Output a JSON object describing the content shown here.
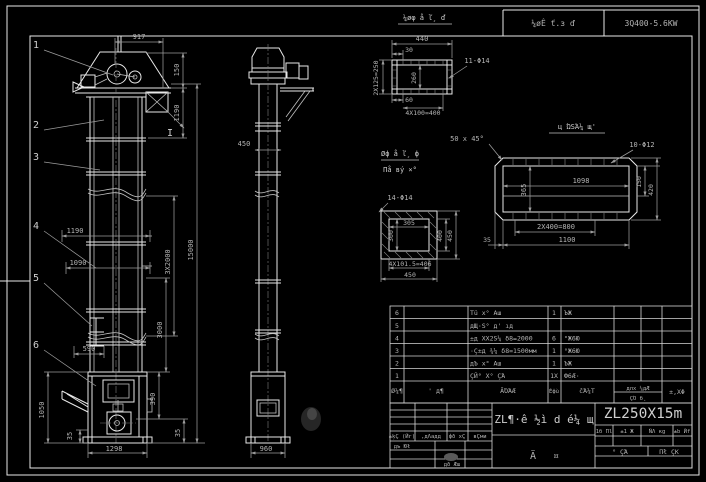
{
  "colors": {
    "background": "#000000",
    "geometry": "#e8e8e8",
    "dimension": "#9c9c9c",
    "text": "#b4b4b4"
  },
  "header": {
    "note": "¼øÊ ť.з ď",
    "spec": "3Q400-5.6KW"
  },
  "front": {
    "balloons": [
      "1",
      "2",
      "3",
      "4",
      "5",
      "6"
    ],
    "section_mark": "I",
    "dims": {
      "top_width": "917",
      "head_h": "150",
      "upper_h": "1190",
      "platform_w1": "1190",
      "platform_w2": "1090",
      "overall_h": "15000",
      "mid_h": "3Χ2000",
      "lower_h": "3000",
      "bucket_pitch": "590",
      "boot_h": "1050",
      "boot_gap": "35",
      "boot_w": "1298",
      "right_mid": "390",
      "right_low": "35"
    }
  },
  "side": {
    "dims": {
      "head_w": "450",
      "boot_w": "960"
    }
  },
  "flange": {
    "title": "¼øφ å ľ¸ ď",
    "dims": {
      "width": "440",
      "offset": "30",
      "holes": "11-Φ14",
      "height": "260",
      "left": "2Χ125=250",
      "edge": "60",
      "pitch": "4Χ100=400"
    }
  },
  "square": {
    "title1": "Øф å ľ¸ ф",
    "title2": "Пå вý ×°",
    "dims": {
      "holes": "14-Φ14",
      "inner_w": "305",
      "inner_h": "300",
      "right_inner": "400",
      "right_outer": "450",
      "pitch": "4Χ101.5=406",
      "width": "450"
    }
  },
  "casing": {
    "title": "ц ΏЅΆ¼ щ'",
    "dims": {
      "chamfer": "50 x 45°",
      "holes": "10-Φ12",
      "inner_w": "1098",
      "inner_h": "365",
      "right_inner": "150",
      "right_outer": "420",
      "pitch": "2Χ400=800",
      "width": "1100",
      "edge": "35"
    }
  },
  "bom": {
    "headers": {
      "no": "Ø¼¶",
      "code": "' д¶",
      "name": "ÃΌΆÆ",
      "qty": "Éфù",
      "material": "čΆ¼T",
      "weight_top": "длх ¼дÆ",
      "weight_bottom": "ÇΌ б¸",
      "note": "±,XΦ"
    },
    "rows": [
      {
        "no": "6",
        "name": "Тü х° Аш",
        "qty": "1",
        "material": "ЪЖ"
      },
      {
        "no": "5",
        "name": "дЩ·Ѕ° д' ıд",
        "qty": "",
        "material": ""
      },
      {
        "no": "4",
        "name": "±д ΧХ2Ѕ¼ δ8=2000",
        "qty": "6",
        "material": "°Ж6Ю"
      },
      {
        "no": "3",
        "name": "·Ç±д ¾¼ δ8=1500мм",
        "qty": "1",
        "material": "°Ж6Ю"
      },
      {
        "no": "2",
        "name": "дЪ х° Аш",
        "qty": "1",
        "material": "ЪЖ"
      },
      {
        "no": "1",
        "name": "ÇЙ° X° ÇΆ",
        "qty": "1X",
        "material": "Ф6Æ·"
      }
    ]
  },
  "titleblock": {
    "revisions": [
      "±ķÇ (Йг)",
      ",дΛадд",
      "фð хÇ",
      "вÇми"
    ],
    "sign1": "дъ Юł",
    "sign2": "дð Æш",
    "title": "ZL¶·ê ½ì d é¼ щ",
    "type1": "Ä",
    "type2": "¤",
    "model": "ZL250X15m",
    "mini": [
      "1б Пl",
      "±1 Ж",
      "ÑΛ кg",
      "±b Йf"
    ],
    "cell1": "° ÇΆ",
    "cell2": "Пł ÇΚ"
  }
}
